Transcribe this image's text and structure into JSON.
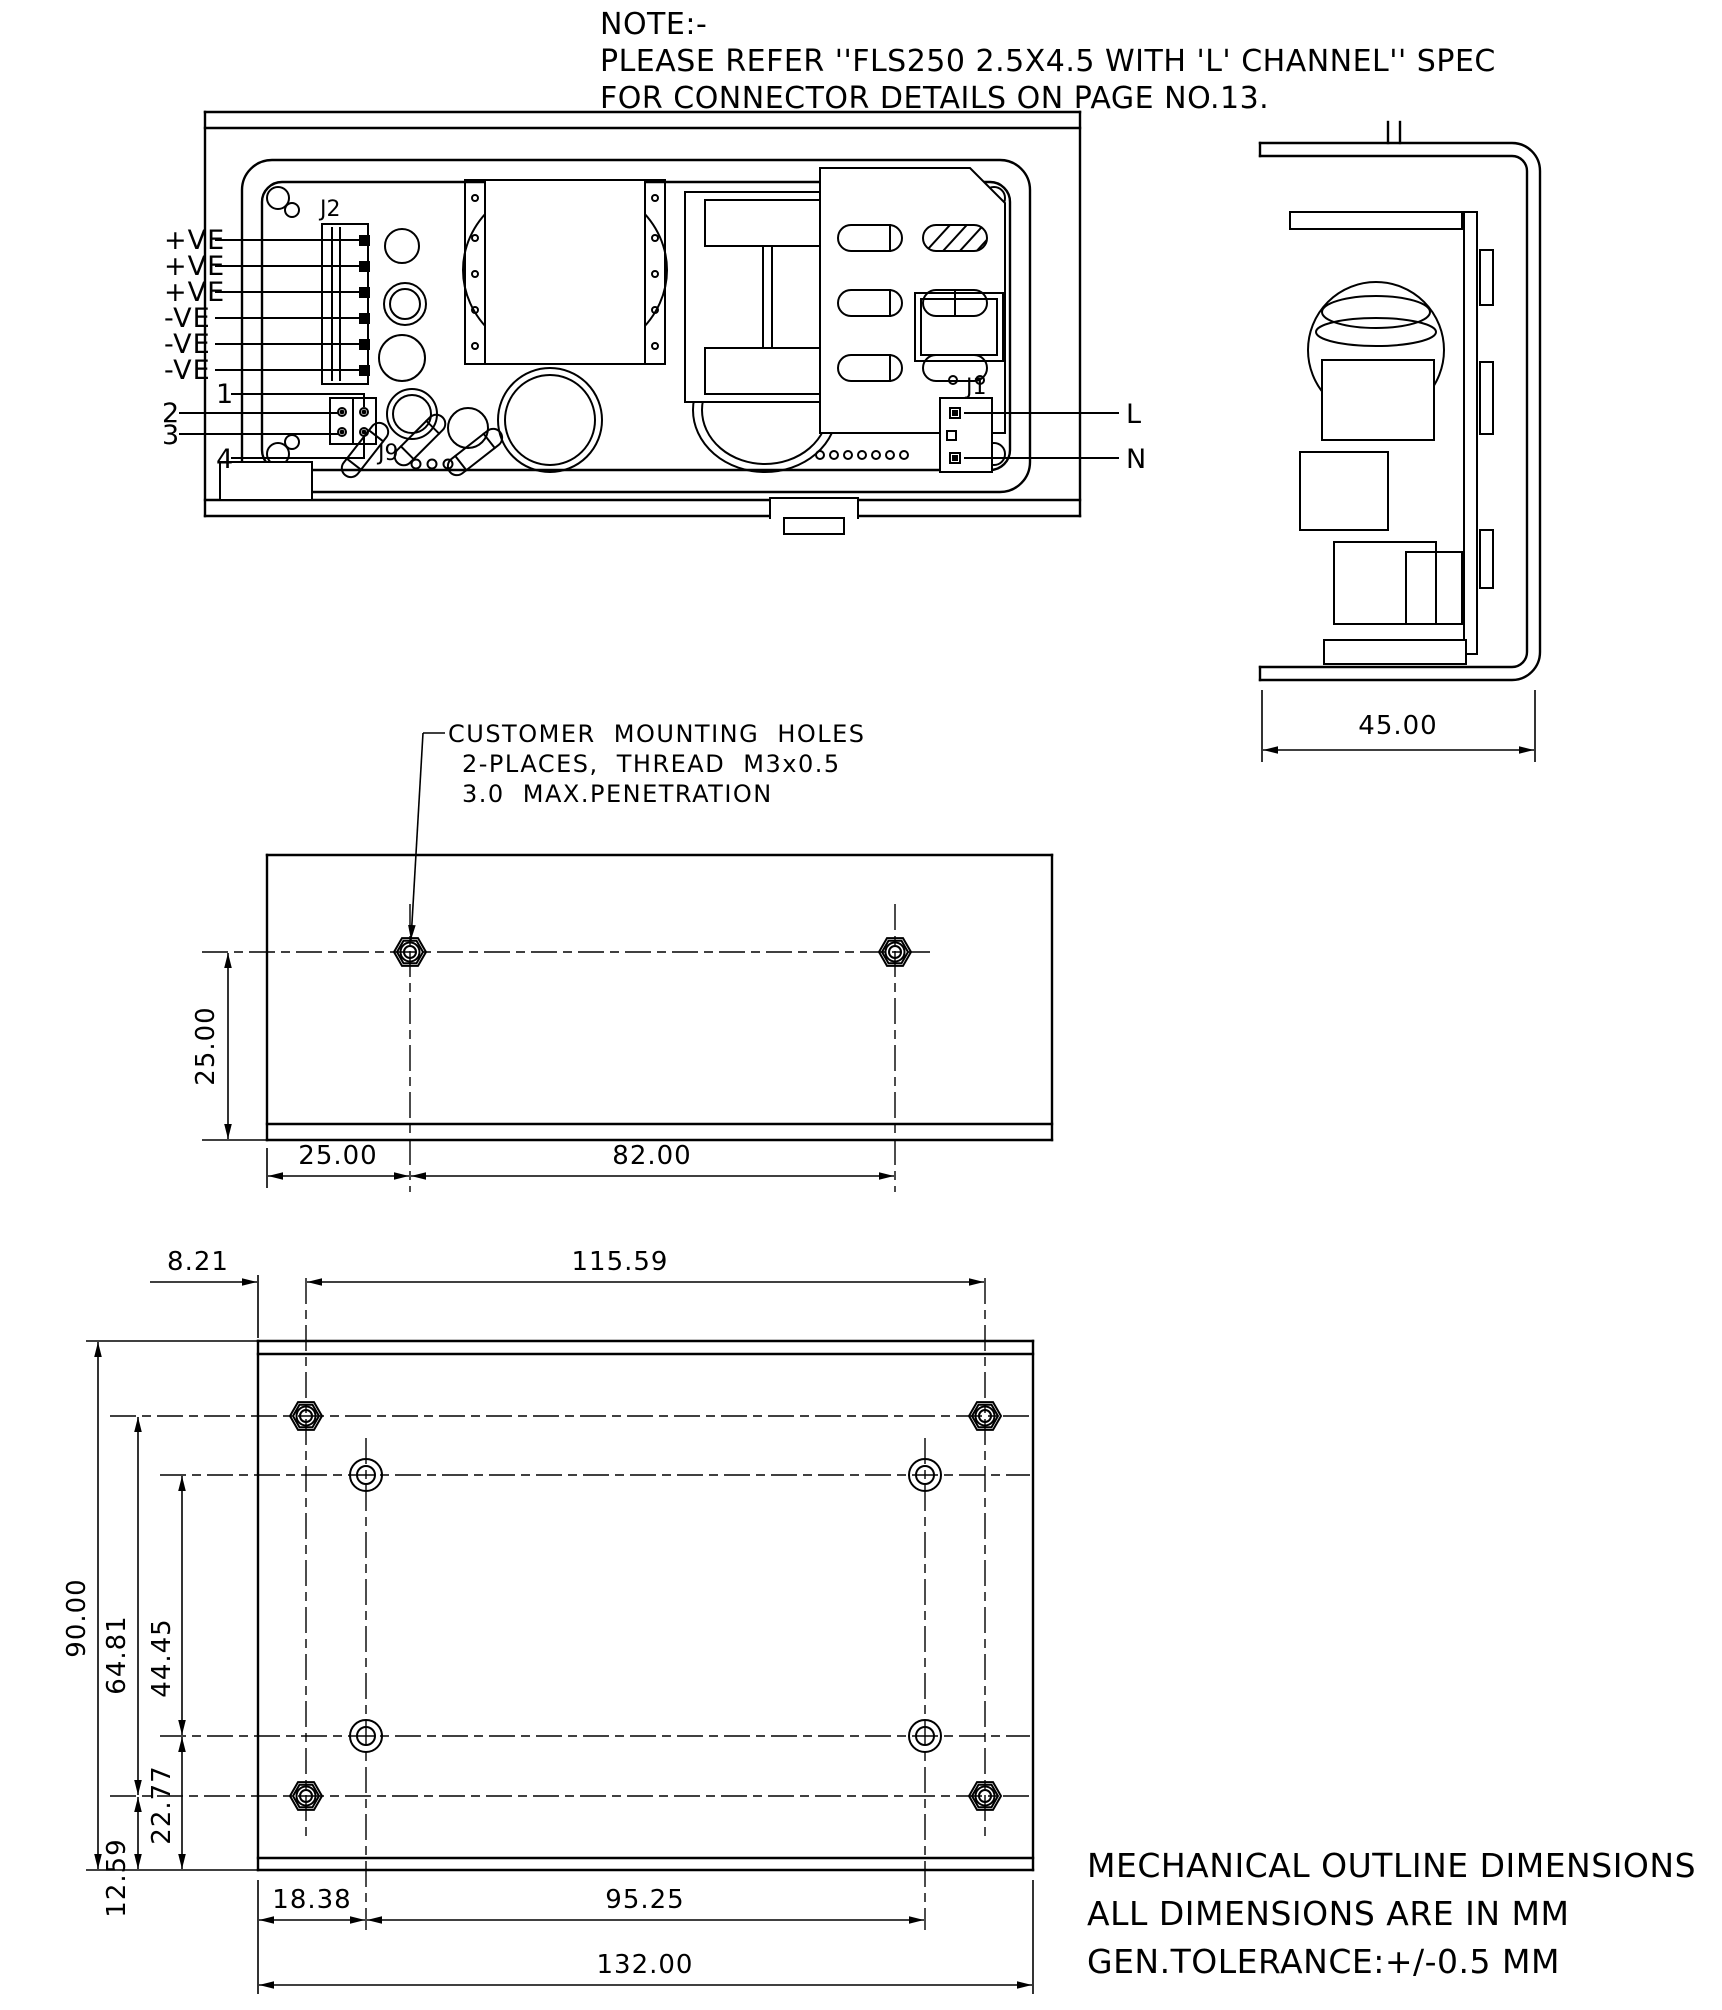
{
  "note": {
    "lines": [
      "NOTE:-",
      "PLEASE REFER ''FLS250 2.5X4.5 WITH 'L' CHANNEL'' SPEC",
      "FOR CONNECTOR DETAILS ON PAGE NO.13."
    ]
  },
  "top_view": {
    "j2_label": "J2",
    "output_labels": [
      "+VE",
      "+VE",
      "+VE",
      "-VE",
      "-VE",
      "-VE"
    ],
    "pin_labels": [
      "1",
      "2",
      "3",
      "4"
    ],
    "aux_connector_label": "J9",
    "j1_label": "J1",
    "line_label": "L",
    "neutral_label": "N"
  },
  "side_view": {
    "depth_dim": "45.00"
  },
  "mounting_view": {
    "callout_lines": [
      "CUSTOMER MOUNTING HOLES",
      "2-PLACES, THREAD M3x0.5",
      "3.0 MAX.PENETRATION"
    ],
    "dim_hole_to_bottom": "25.00",
    "dim_left_to_hole": "25.00",
    "dim_hole_spacing": "82.00"
  },
  "bottom_view": {
    "dim_left_edge_to_corner_hole": "8.21",
    "dim_corner_hole_spacing_x": "115.59",
    "dim_height": "90.00",
    "dim_corner_hole_spacing_y": "64.81",
    "dim_inner_hole_spacing_y": "44.45",
    "dim_inner_hole_to_bottom": "22.77",
    "dim_corner_hole_to_bottom": "12.59",
    "dim_left_edge_to_inner_hole": "18.38",
    "dim_inner_hole_spacing_x": "95.25",
    "dim_width": "132.00"
  },
  "footer": {
    "lines": [
      "MECHANICAL OUTLINE DIMENSIONS",
      "ALL DIMENSIONS ARE IN MM",
      "GEN.TOLERANCE:+/-0.5 MM"
    ]
  },
  "colors": {
    "line": "#000000",
    "background": "#ffffff"
  }
}
